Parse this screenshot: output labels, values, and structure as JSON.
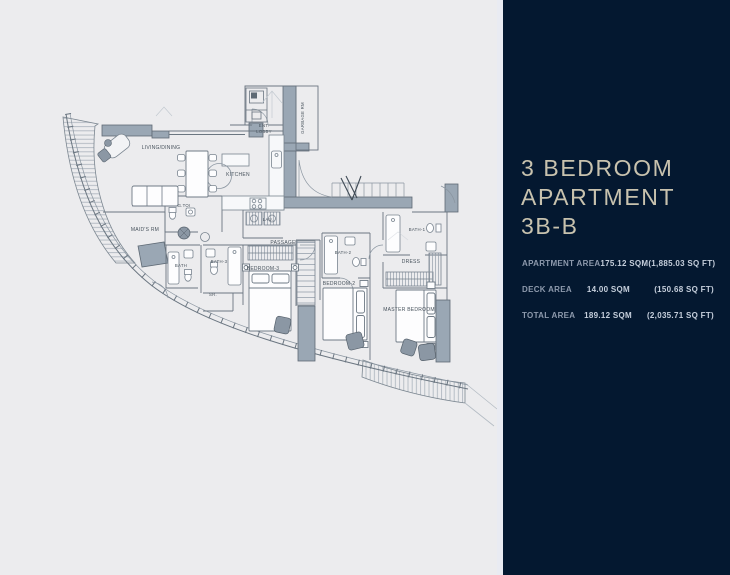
{
  "page": {
    "background_color": "#ececee"
  },
  "panel": {
    "title_lines": [
      "3 BEDROOM",
      "APARTMENT",
      "3B-B"
    ],
    "rows": [
      {
        "label": "APARTMENT AREA",
        "sqm": "175.12 SQM",
        "sqft": "(1,885.03 SQ FT)"
      },
      {
        "label": "DECK AREA",
        "sqm": "14.00 SQM",
        "sqft": "(150.68 SQ FT)"
      },
      {
        "label": "TOTAL AREA",
        "sqm": "189.12 SQM",
        "sqft": "(2,035.71 SQ FT)"
      }
    ],
    "colors": {
      "background": "#041830",
      "title_text": "#c8c2ae",
      "row_label": "#8e9aad",
      "row_value": "#c6cfdc"
    }
  },
  "plan": {
    "colors": {
      "thick_wall": "#9aa7b4",
      "thin_wall": "#6b7681",
      "label_text": "#47525c"
    },
    "labels": [
      {
        "id": "living-dining",
        "text": "LIVING/DINING"
      },
      {
        "id": "kitchen",
        "text": "KITCHEN"
      },
      {
        "id": "ent",
        "text": "ENT."
      },
      {
        "id": "lobby",
        "text": "LOBBY"
      },
      {
        "id": "garbage-rm",
        "text": "GARBAGE RM"
      },
      {
        "id": "g-toi",
        "text": "G.TOI"
      },
      {
        "id": "maids-rm",
        "text": "MAID'S RM"
      },
      {
        "id": "lau",
        "text": "LAU."
      },
      {
        "id": "passage",
        "text": "PASSAGE"
      },
      {
        "id": "bath",
        "text": "BATH"
      },
      {
        "id": "bath-3",
        "text": "BATH-3"
      },
      {
        "id": "sr",
        "text": "SR."
      },
      {
        "id": "bedroom-3",
        "text": "BEDROOM-3"
      },
      {
        "id": "bath-2",
        "text": "BATH-2"
      },
      {
        "id": "bedroom-2",
        "text": "BEDROOM-2"
      },
      {
        "id": "bath-1",
        "text": "BATH-1"
      },
      {
        "id": "dress",
        "text": "DRESS"
      },
      {
        "id": "master-bedroom",
        "text": "MASTER BEDROOM"
      }
    ]
  }
}
